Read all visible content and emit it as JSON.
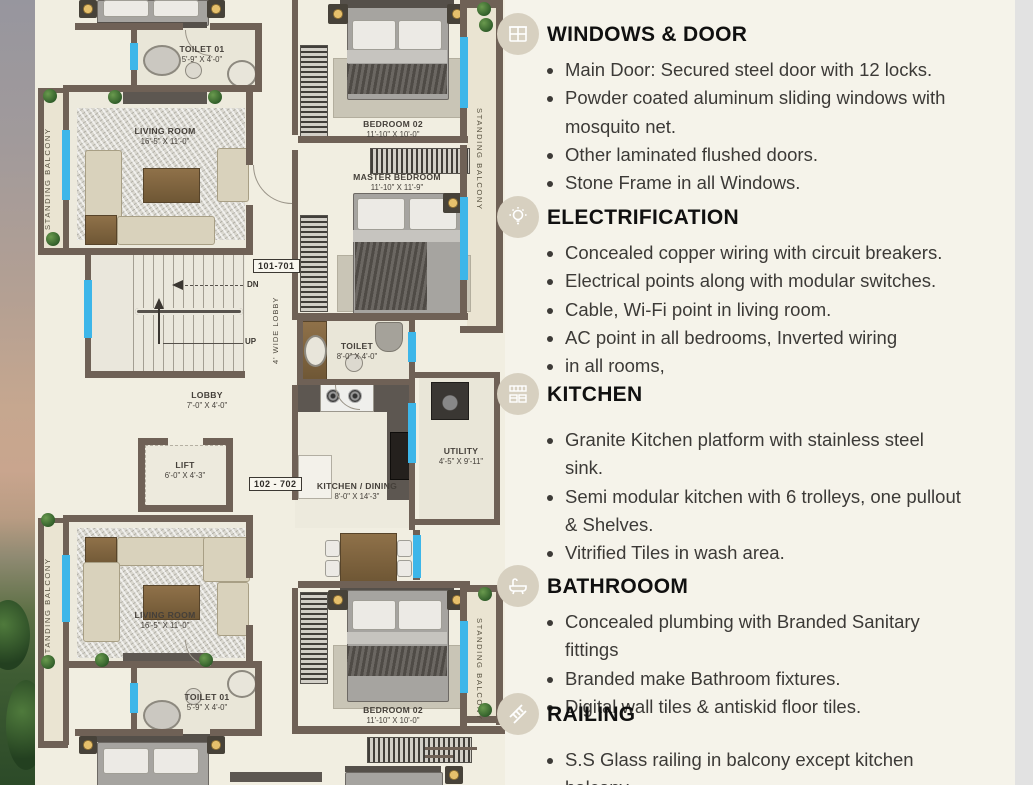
{
  "plan": {
    "unit_label_top": "101-701",
    "unit_label_bottom": "102 - 702",
    "stair_dn": "DN",
    "stair_up": "UP",
    "lobby_width_label": "4' WIDE LOBBY",
    "balcony_label": "STANDING BALCONY",
    "rooms": {
      "toilet01": {
        "name": "TOILET 01",
        "dims": "5'-9\" X 4'-0\""
      },
      "living": {
        "name": "LIVING ROOM",
        "dims": "16'-5\" X 11'-0\""
      },
      "bedroom02": {
        "name": "BEDROOM 02",
        "dims": "11'-10\" X 10'-0\""
      },
      "master": {
        "name": "MASTER BEDROOM",
        "dims": "11'-10\" X 11'-9\""
      },
      "toilet": {
        "name": "TOILET",
        "dims": "8'-0\" X 4'-0\""
      },
      "lobby": {
        "name": "LOBBY",
        "dims": "7'-0\" X 4'-0\""
      },
      "lift": {
        "name": "LIFT",
        "dims": "6'-0\" X 4'-3\""
      },
      "utility": {
        "name": "UTILITY",
        "dims": "4'-5\" X 9'-11\""
      },
      "kitchen": {
        "name": "KITCHEN / DINING",
        "dims": "8'-0\" X 14'-3\""
      }
    },
    "colors": {
      "wall": "#6f6156",
      "window": "#3db6e9"
    }
  },
  "specs": {
    "sections": [
      {
        "icon": "window-icon",
        "title": "WINDOWS & DOOR",
        "bullets": [
          "Main Door: Secured steel door with 12 locks.",
          "Powder coated aluminum sliding windows with mosquito net.",
          "Other laminated flushed doors.",
          "Stone Frame in all Windows."
        ]
      },
      {
        "icon": "bulb-icon",
        "title": "ELECTRIFICATION",
        "bullets": [
          "Concealed copper wiring with circuit breakers.",
          "Electrical points along with modular switches.",
          "Cable, Wi-Fi point in living room.",
          "AC point in all bedrooms, Inverted wiring",
          "in all rooms,"
        ]
      },
      {
        "icon": "kitchen-icon",
        "title": "KITCHEN",
        "bullets": [
          "Granite Kitchen platform with stainless steel sink.",
          "Semi modular kitchen with 6 trolleys, one pullout & Shelves.",
          "Vitrified Tiles in wash area."
        ]
      },
      {
        "icon": "bathtub-icon",
        "title": "BATHROOOM",
        "bullets": [
          "Concealed plumbing with Branded Sanitary fittings",
          "Branded make Bathroom fixtures.",
          "Digital wall tiles & antiskid floor tiles."
        ]
      },
      {
        "icon": "railing-icon",
        "title": "RAILING",
        "bullets": [
          "S.S Glass railing in balcony except kitchen balcony"
        ]
      }
    ]
  }
}
